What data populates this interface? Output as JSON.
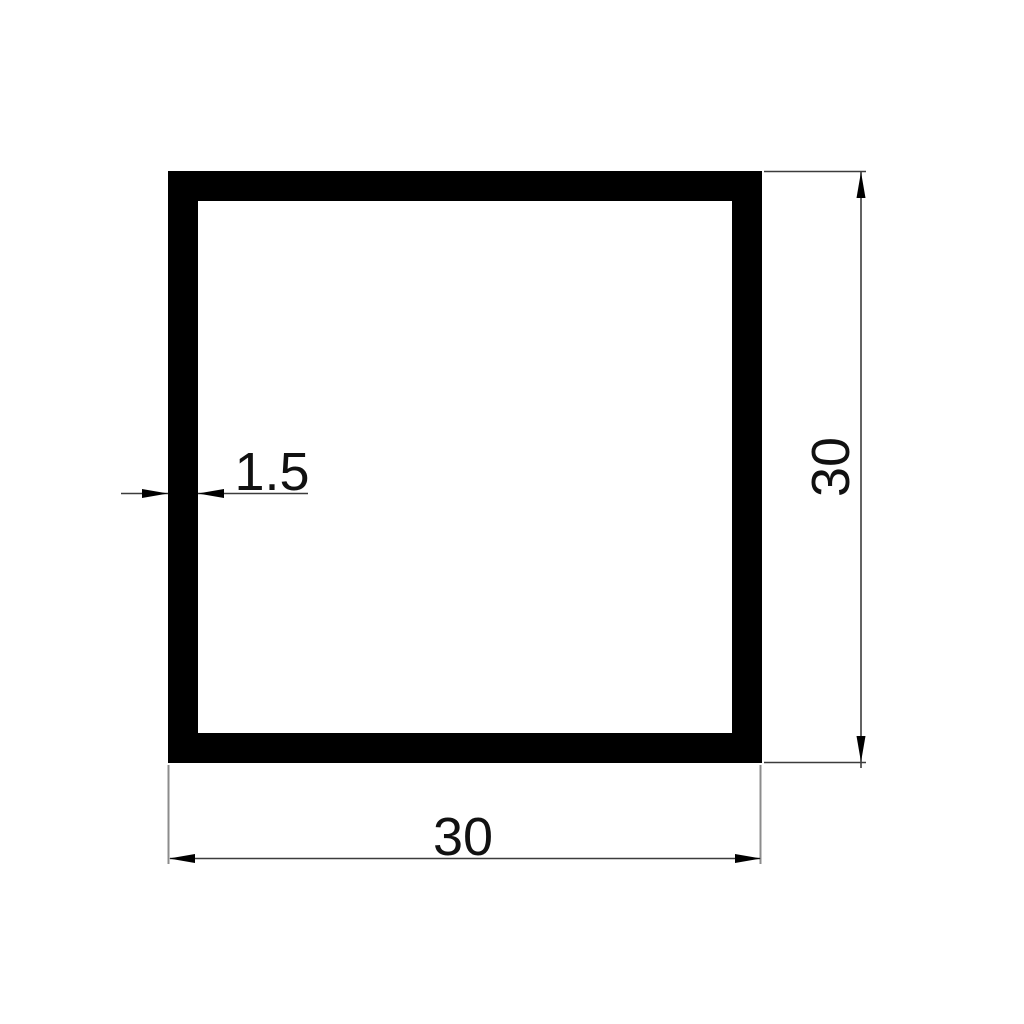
{
  "drawing": {
    "type": "technical-cross-section",
    "subject": "square hollow tube profile",
    "background": "#ffffff",
    "dimensions": {
      "outer_width": {
        "label": "30",
        "orientation": "horizontal",
        "position": "bottom"
      },
      "outer_height": {
        "label": "30",
        "orientation": "vertical-rotated",
        "position": "right"
      },
      "wall_thickness": {
        "label": "1.5",
        "orientation": "horizontal",
        "position": "left-inside"
      }
    }
  },
  "colors": {
    "profile": "#000000",
    "dimension_line": "#3c3c3c",
    "extension_line": "#8c8c8c",
    "arrow": "#000000",
    "text": "#111111",
    "background": "#ffffff"
  }
}
